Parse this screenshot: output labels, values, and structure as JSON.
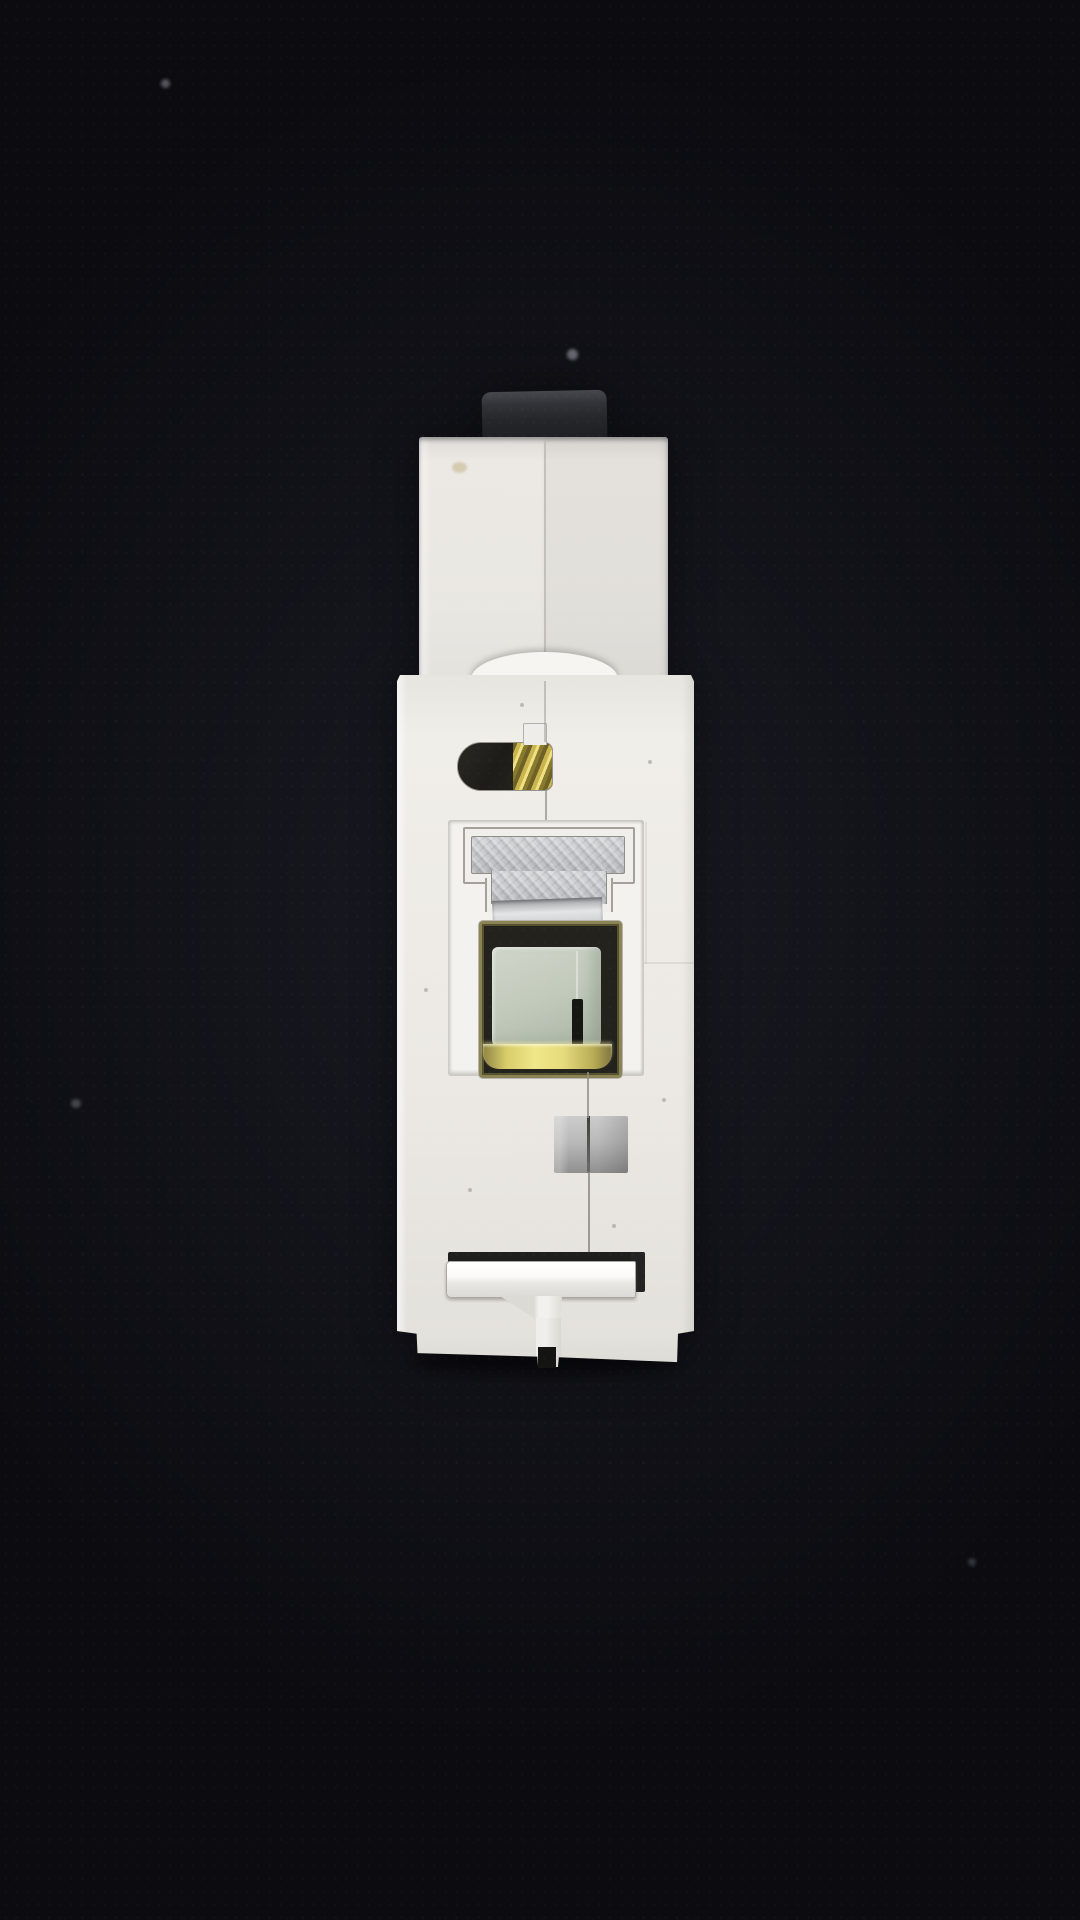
{
  "scene": {
    "type": "photograph",
    "description": "Single-pole DIN-rail miniature circuit breaker photographed end-on from the terminal side, lying on a dark charcoal textured surface with strong vignette",
    "text_visible": "none"
  },
  "device": {
    "label": "miniature-circuit-breaker-end-view",
    "parts": [
      {
        "name": "din-rail-clip",
        "desc": "dark grey spring clip protruding at top"
      },
      {
        "name": "top-housing-block",
        "desc": "narrow white moulded block with centre mould seam and toggle recess mound"
      },
      {
        "name": "main-housing",
        "desc": "wide white breaker body with chamfered bottom corners"
      },
      {
        "name": "terminal-screw-slot",
        "desc": "stadium-shaped opening showing brass screw threads"
      },
      {
        "name": "terminal-panel",
        "desc": "recessed white panel framing the terminal hardware"
      },
      {
        "name": "metal-clamp-t",
        "desc": "T-shaped textured steel clamp plate with rolled lower edge"
      },
      {
        "name": "terminal-cavity",
        "desc": "brass-rimmed dark cavity"
      },
      {
        "name": "terminal-block-green",
        "desc": "pale sage-green clamp block with dark slit"
      },
      {
        "name": "brass-glow-strip",
        "desc": "bright gold reflection at cavity bottom"
      },
      {
        "name": "latch-window",
        "desc": "grey gradient square window with mould seam"
      },
      {
        "name": "din-release-latch",
        "desc": "white sliding latch bar over dark slot with centre stem and slit"
      }
    ]
  },
  "colors": {
    "bg_mid": "#1a1b23",
    "bg_dark": "#0b0b10",
    "plastic": "#ece9e4",
    "plastic_bright": "#f6f5f1",
    "panel": "#f3f2ee",
    "clip_dark": "#26272b",
    "clip_light": "#47484d",
    "metal_light": "#d6d8da",
    "metal_mid": "#c6c8cb",
    "metal_dark": "#8e9092",
    "brass_dark": "#6d6127",
    "brass_mid": "#c9b44e",
    "brass_light": "#efe084",
    "cavity_dark": "#23221d",
    "slot_black": "#161613",
    "green_light": "#d0d6c9",
    "green_mid": "#c2cabc",
    "green_dark": "#a9b3a4",
    "gold_glow": "#f0e78a",
    "gold_deep": "#8f8444",
    "grey_sq_light": "#cccccc",
    "grey_sq_dark": "#909090",
    "line_grey": "#8f8d88"
  }
}
